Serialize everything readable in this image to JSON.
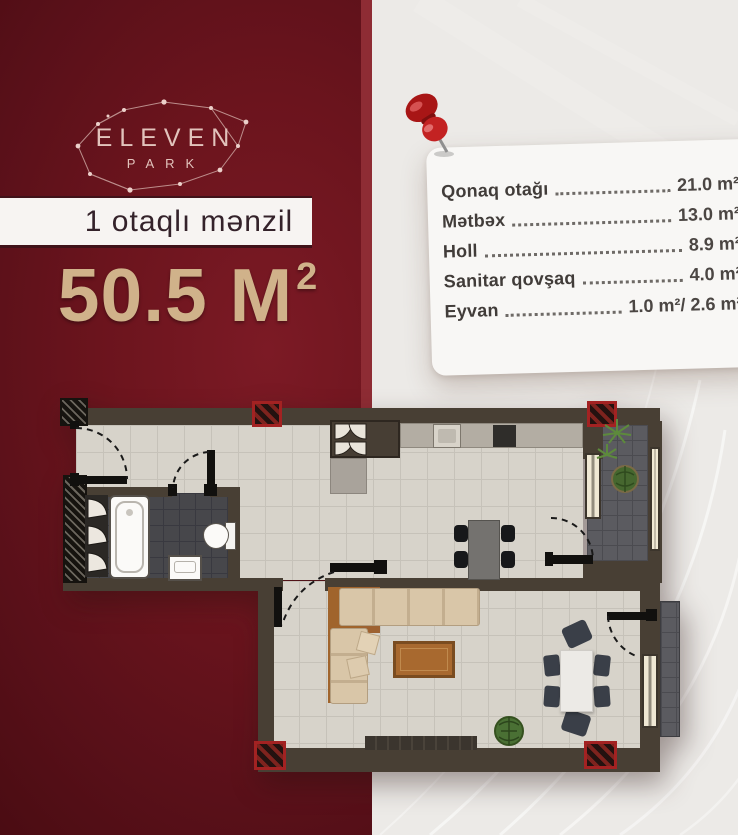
{
  "brand": {
    "name_top": "ELEVEN",
    "name_bottom": "PARK"
  },
  "listing": {
    "type_label": "1 otaqlı mənzil",
    "total_area_value": "50.5 M",
    "total_area_sup": "2"
  },
  "room_table": {
    "rows": [
      {
        "label": "Qonaq otağı",
        "area": "21.0 m²"
      },
      {
        "label": "Mətbəx",
        "area": "13.0 m²"
      },
      {
        "label": "Holl",
        "area": "8.9 m²"
      },
      {
        "label": "Sanitar qovşaq",
        "area": "4.0 m²"
      },
      {
        "label": "Eyvan",
        "area": "1.0 m²/ 2.6 m²"
      }
    ]
  },
  "icons": {
    "pin": "red-pushpin-icon",
    "logo_constellation": "constellation-icon"
  },
  "colors": {
    "maroon": "#6b141d",
    "maroon_dark": "#470b11",
    "gold": "#d0b28a",
    "banner_bg": "#f7f4f2",
    "banner_text": "#34222a",
    "card_bg": "#f8f7f5",
    "bg_gray": "#eceae7",
    "wall": "#483f34",
    "floor_tile": "#d7d3ca",
    "bath_tile": "#47474b",
    "balcony_tile": "#5b5b60",
    "column_red": "#a32222"
  }
}
